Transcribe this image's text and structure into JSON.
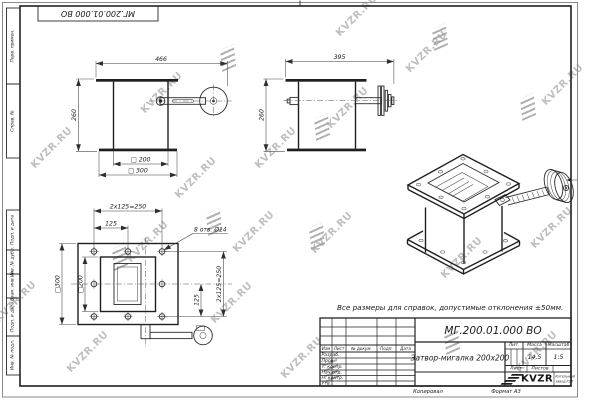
{
  "sheet": {
    "designation": "МГ.200.01.000 ВО",
    "title": "Затвор-мигалка 200x200",
    "note": "Все размеры для справок, допустимые отклонения ±50мм.",
    "mass_value": "14,5",
    "scale_value": "1:5",
    "copied_label": "Копировал",
    "format_label": "Формат А3"
  },
  "frame_fields": [
    "Перв. примен.",
    "Справ. №",
    "Подп. и дата",
    "Инв. № дубл.",
    "Взам. инв. №",
    "Подп. и дата",
    "Инв. № подл."
  ],
  "titleblock": {
    "change_header": [
      "Изм",
      "Лист",
      "№ докум.",
      "Подп.",
      "Дата"
    ],
    "roles": [
      "Разраб.",
      "Пров.",
      "Т. контр.",
      "Нач.отд.",
      "Н. контр.",
      "Утв."
    ],
    "lit_label": "Лит.",
    "mass_label": "Масса",
    "scale_label": "Масштаб",
    "sheet_label": "Лист",
    "sheets_label": "Листов",
    "company": {
      "logo": "KVZR",
      "line1": "Котельный",
      "line2": "завод РЭП"
    }
  },
  "views": {
    "front": {
      "dim_width": "466",
      "dim_height": "260",
      "dim_inner": "□ 200",
      "dim_outer": "□ 300"
    },
    "side": {
      "dim_width": "395",
      "dim_height": "260"
    },
    "plan": {
      "dim_pitch": "125",
      "dim_pitch_total": "2x125=250",
      "dim_holes": "8 отв. Ø14",
      "dim_outer": "□300",
      "dim_inner": "□200",
      "dim_pitch_right": "125",
      "dim_pitch_total_right": "2x125=250"
    }
  },
  "watermarks": {
    "text": "KVZR.RU",
    "text_positions": [
      [
        52,
        148
      ],
      [
        16,
        302
      ],
      [
        88,
        352
      ],
      [
        162,
        93
      ],
      [
        148,
        242
      ],
      [
        232,
        303
      ],
      [
        276,
        148
      ],
      [
        254,
        232
      ],
      [
        348,
        108
      ],
      [
        332,
        233
      ],
      [
        302,
        358
      ],
      [
        427,
        52
      ],
      [
        462,
        258
      ],
      [
        552,
        228
      ],
      [
        537,
        352
      ],
      [
        563,
        85
      ],
      [
        357,
        16
      ],
      [
        196,
        178
      ]
    ],
    "mark_positions": [
      [
        228,
        58
      ],
      [
        214,
        222
      ],
      [
        322,
        127
      ],
      [
        317,
        236
      ],
      [
        440,
        37
      ],
      [
        452,
        341
      ],
      [
        528,
        107
      ],
      [
        331,
        369
      ],
      [
        120,
        257
      ]
    ]
  }
}
